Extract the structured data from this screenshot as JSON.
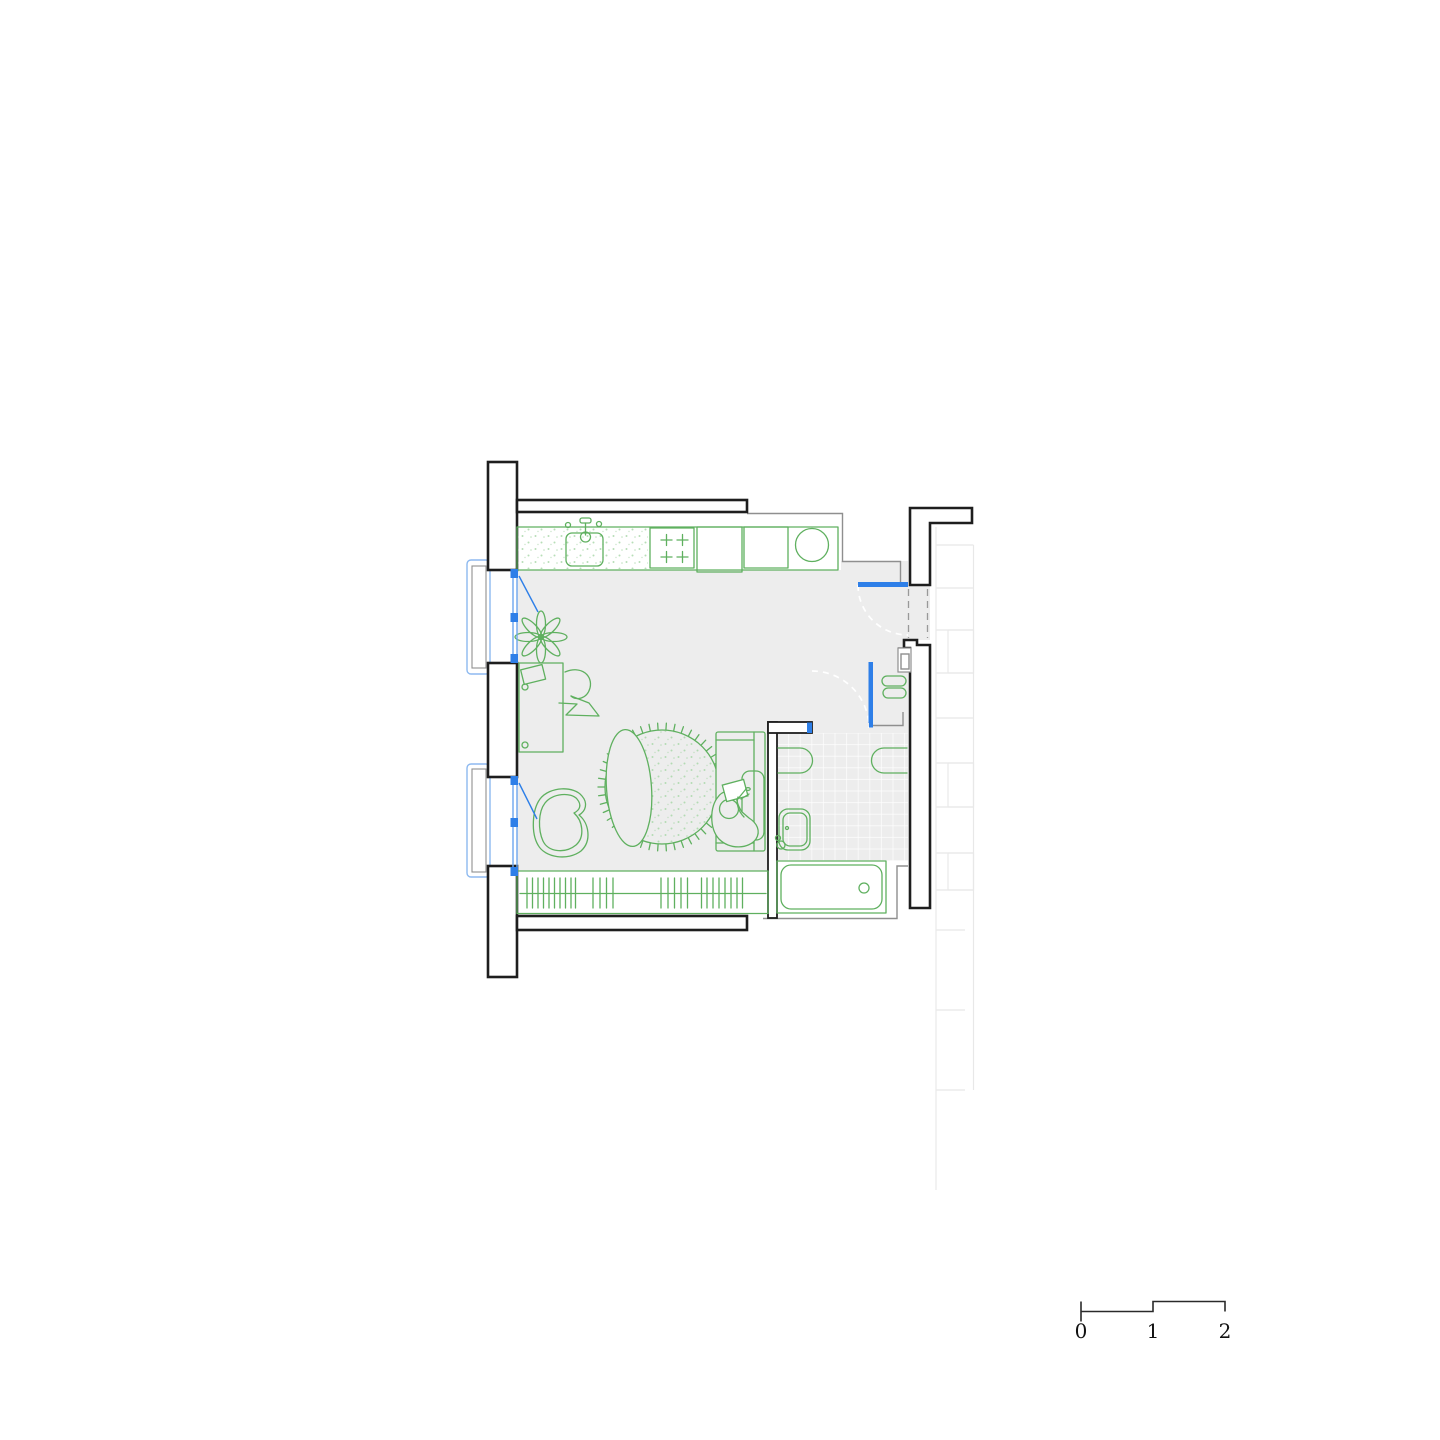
{
  "scale_bar": {
    "labels": [
      "0",
      "1",
      "2"
    ]
  },
  "colors": {
    "wall_stroke": "#1e1e1e",
    "partition_gray": "#8f8f8f",
    "floor": "#ededed",
    "furniture_green": "#5fb05f",
    "stipple_green": "#a5d6a5",
    "opening_blue": "#2e7fe8",
    "window_blue": "#6da6ee",
    "balcony_blue": "#8db9f0",
    "faint_gray": "#e8e8e8",
    "dashed_gray": "#999999"
  },
  "icons": {
    "plant": "potted-plant-icon",
    "sink": "kitchen-sink-icon",
    "stove": "four-burner-stove-icon",
    "rug": "round-rug-icon",
    "sofa": "sofa-with-person-icon",
    "bathtub": "bathtub-icon",
    "washbasin": "washbasin-icon",
    "wardrobe": "wardrobe-hangers-icon"
  }
}
